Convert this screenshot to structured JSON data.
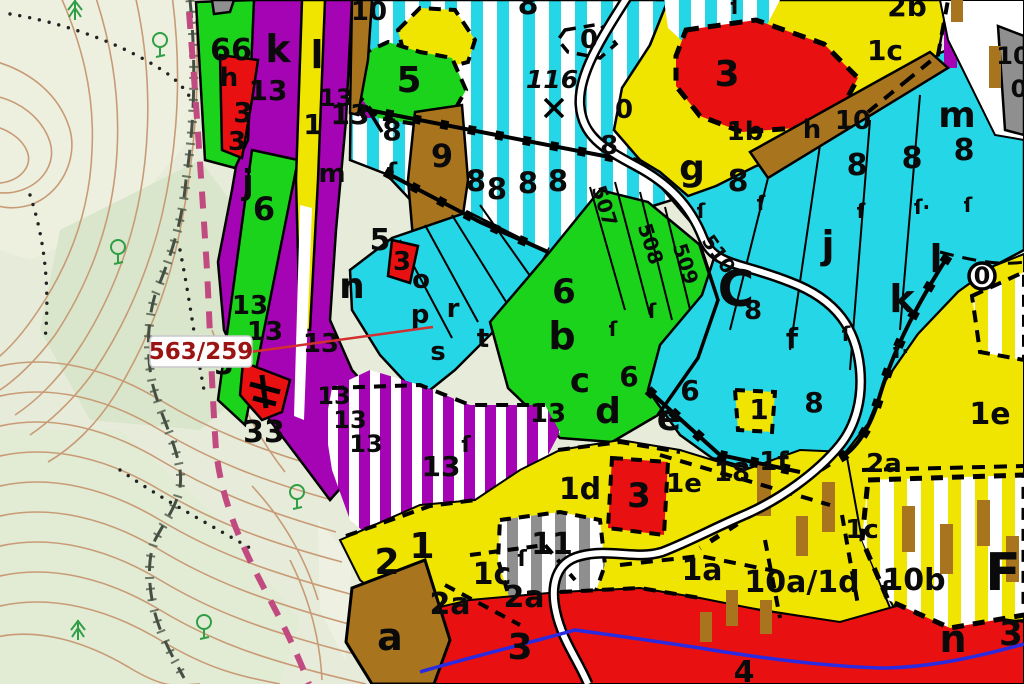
{
  "map": {
    "type": "forest-management-cadastral-map",
    "callout": {
      "parcel_number": "563/259",
      "text_color": "#9b1414"
    },
    "colors": {
      "topo_bg": "#e6ecd9",
      "contour": "#c89b76",
      "parcel_purple": "#a404b4",
      "parcel_green": "#1bd31b",
      "parcel_cyan": "#25d6e6",
      "parcel_yellow": "#f0e500",
      "parcel_red": "#e81010",
      "parcel_brown": "#a8751e",
      "parcel_gray": "#8f8f8f",
      "boundary_pink": "#c14b80",
      "river_blue": "#2a2ae0",
      "road_fill": "#ffffff",
      "road_casing": "#000000",
      "label": "#0a0a0a",
      "tree_green": "#2f9e44"
    },
    "trees": [
      {
        "k": "conifer",
        "x": 75,
        "y": 12
      },
      {
        "k": "deciduous",
        "x": 160,
        "y": 48
      },
      {
        "k": "deciduous",
        "x": 118,
        "y": 255
      },
      {
        "k": "deciduous",
        "x": 297,
        "y": 500
      },
      {
        "k": "conifer",
        "x": 78,
        "y": 632
      },
      {
        "k": "deciduous",
        "x": 204,
        "y": 630
      }
    ],
    "labels": [
      {
        "t": "66",
        "x": 231,
        "y": 60,
        "s": 30
      },
      {
        "t": "h",
        "x": 229,
        "y": 86,
        "s": 26
      },
      {
        "t": "13",
        "x": 268,
        "y": 100,
        "s": 28
      },
      {
        "t": "3",
        "x": 243,
        "y": 122,
        "s": 28
      },
      {
        "t": "3",
        "x": 237,
        "y": 150,
        "s": 26
      },
      {
        "t": "k",
        "x": 278,
        "y": 62,
        "s": 38
      },
      {
        "t": "l",
        "x": 317,
        "y": 68,
        "s": 38
      },
      {
        "t": "1",
        "x": 313,
        "y": 134,
        "s": 28
      },
      {
        "t": "13",
        "x": 336,
        "y": 106,
        "s": 24
      },
      {
        "t": "13",
        "x": 350,
        "y": 124,
        "s": 28
      },
      {
        "t": "8",
        "x": 392,
        "y": 140,
        "s": 28
      },
      {
        "t": "m",
        "x": 332,
        "y": 182,
        "s": 26
      },
      {
        "t": "j",
        "x": 248,
        "y": 194,
        "s": 34
      },
      {
        "t": "6",
        "x": 264,
        "y": 220,
        "s": 32
      },
      {
        "t": "5",
        "x": 409,
        "y": 92,
        "s": 36
      },
      {
        "t": "10",
        "x": 369,
        "y": 20,
        "s": 26
      },
      {
        "t": "9",
        "x": 442,
        "y": 167,
        "s": 32
      },
      {
        "t": "ſ",
        "x": 392,
        "y": 180,
        "s": 24
      },
      {
        "t": "n",
        "x": 352,
        "y": 298,
        "s": 36
      },
      {
        "t": "o",
        "x": 421,
        "y": 288,
        "s": 26
      },
      {
        "t": "p",
        "x": 420,
        "y": 323,
        "s": 26
      },
      {
        "t": "r",
        "x": 453,
        "y": 317,
        "s": 26
      },
      {
        "t": "s",
        "x": 438,
        "y": 360,
        "s": 26
      },
      {
        "t": "t",
        "x": 483,
        "y": 347,
        "s": 26
      },
      {
        "t": "3",
        "x": 402,
        "y": 270,
        "s": 26
      },
      {
        "t": "5",
        "x": 380,
        "y": 250,
        "s": 30
      },
      {
        "t": "13",
        "x": 250,
        "y": 314,
        "s": 26
      },
      {
        "t": "13",
        "x": 265,
        "y": 340,
        "s": 26
      },
      {
        "t": "13",
        "x": 321,
        "y": 352,
        "s": 26
      },
      {
        "t": "3",
        "x": 224,
        "y": 374,
        "s": 28
      },
      {
        "t": "33",
        "x": 264,
        "y": 442,
        "s": 30
      },
      {
        "t": "13",
        "x": 334,
        "y": 404,
        "s": 24
      },
      {
        "t": "13",
        "x": 350,
        "y": 428,
        "s": 24
      },
      {
        "t": "13",
        "x": 366,
        "y": 452,
        "s": 24
      },
      {
        "t": "13",
        "x": 441,
        "y": 476,
        "s": 28
      },
      {
        "t": "13",
        "x": 548,
        "y": 422,
        "s": 26
      },
      {
        "t": "ſ",
        "x": 466,
        "y": 452,
        "s": 22
      },
      {
        "t": "8",
        "x": 528,
        "y": 14,
        "s": 30
      },
      {
        "t": "ſ",
        "x": 735,
        "y": 14,
        "s": 22
      },
      {
        "t": "0",
        "x": 589,
        "y": 48,
        "s": 26
      },
      {
        "t": "116",
        "x": 552,
        "y": 88,
        "s": 25,
        "i": 1
      },
      {
        "t": "0",
        "x": 624,
        "y": 118,
        "s": 26
      },
      {
        "t": "8",
        "x": 609,
        "y": 154,
        "s": 26
      },
      {
        "t": "8",
        "x": 476,
        "y": 191,
        "s": 29
      },
      {
        "t": "8",
        "x": 497,
        "y": 199,
        "s": 29
      },
      {
        "t": "8",
        "x": 528,
        "y": 193,
        "s": 29
      },
      {
        "t": "8",
        "x": 558,
        "y": 191,
        "s": 29
      },
      {
        "t": "507",
        "x": 598,
        "y": 208,
        "s": 20,
        "r": 72
      },
      {
        "t": "508",
        "x": 644,
        "y": 246,
        "s": 20,
        "r": 72
      },
      {
        "t": "509",
        "x": 679,
        "y": 266,
        "s": 20,
        "r": 72
      },
      {
        "t": "510",
        "x": 713,
        "y": 258,
        "s": 20,
        "r": 55
      },
      {
        "t": "2b",
        "x": 907,
        "y": 16,
        "s": 28
      },
      {
        "t": "1c",
        "x": 885,
        "y": 60,
        "s": 28
      },
      {
        "t": "3",
        "x": 727,
        "y": 86,
        "s": 36
      },
      {
        "t": "1b",
        "x": 745,
        "y": 140,
        "s": 26
      },
      {
        "t": "h",
        "x": 812,
        "y": 138,
        "s": 26
      },
      {
        "t": "10",
        "x": 853,
        "y": 129,
        "s": 26
      },
      {
        "t": "g",
        "x": 692,
        "y": 180,
        "s": 36
      },
      {
        "t": "8",
        "x": 738,
        "y": 191,
        "s": 30
      },
      {
        "t": "8",
        "x": 857,
        "y": 175,
        "s": 30
      },
      {
        "t": "8",
        "x": 912,
        "y": 168,
        "s": 30
      },
      {
        "t": "8",
        "x": 964,
        "y": 160,
        "s": 30
      },
      {
        "t": "m",
        "x": 957,
        "y": 127,
        "s": 36
      },
      {
        "t": "10",
        "x": 1013,
        "y": 64,
        "s": 24
      },
      {
        "t": "0",
        "x": 1019,
        "y": 97,
        "s": 24
      },
      {
        "t": "ſ",
        "x": 701,
        "y": 218,
        "s": 20
      },
      {
        "t": "ſ",
        "x": 761,
        "y": 210,
        "s": 20
      },
      {
        "t": "ſ",
        "x": 861,
        "y": 218,
        "s": 20
      },
      {
        "t": "ſ·",
        "x": 922,
        "y": 214,
        "s": 20
      },
      {
        "t": "ſ",
        "x": 968,
        "y": 212,
        "s": 20
      },
      {
        "t": "C",
        "x": 736,
        "y": 306,
        "s": 50
      },
      {
        "t": "8",
        "x": 753,
        "y": 319,
        "s": 26
      },
      {
        "t": "f",
        "x": 792,
        "y": 348,
        "s": 28
      },
      {
        "t": "j",
        "x": 828,
        "y": 258,
        "s": 38
      },
      {
        "t": "k",
        "x": 902,
        "y": 312,
        "s": 38
      },
      {
        "t": "l",
        "x": 936,
        "y": 272,
        "s": 38
      },
      {
        "t": "0",
        "x": 982,
        "y": 284,
        "s": 24
      },
      {
        "t": "8",
        "x": 814,
        "y": 412,
        "s": 28
      },
      {
        "t": "1",
        "x": 759,
        "y": 419,
        "s": 28
      },
      {
        "t": "ſ",
        "x": 846,
        "y": 341,
        "s": 20
      },
      {
        "t": "ſ·",
        "x": 901,
        "y": 358,
        "s": 20
      },
      {
        "t": "6",
        "x": 564,
        "y": 303,
        "s": 34
      },
      {
        "t": "b",
        "x": 562,
        "y": 349,
        "s": 38
      },
      {
        "t": "c",
        "x": 580,
        "y": 392,
        "s": 34
      },
      {
        "t": "6",
        "x": 629,
        "y": 386,
        "s": 28
      },
      {
        "t": "d",
        "x": 608,
        "y": 423,
        "s": 36
      },
      {
        "t": "6",
        "x": 690,
        "y": 400,
        "s": 28
      },
      {
        "t": "e",
        "x": 669,
        "y": 430,
        "s": 36
      },
      {
        "t": "ſ",
        "x": 613,
        "y": 336,
        "s": 20
      },
      {
        "t": "ſ",
        "x": 652,
        "y": 318,
        "s": 20
      },
      {
        "t": "2",
        "x": 387,
        "y": 574,
        "s": 36
      },
      {
        "t": "1",
        "x": 422,
        "y": 558,
        "s": 36
      },
      {
        "t": "11",
        "x": 552,
        "y": 554,
        "s": 30
      },
      {
        "t": "ſ",
        "x": 522,
        "y": 566,
        "s": 22
      },
      {
        "t": "1c",
        "x": 492,
        "y": 584,
        "s": 30
      },
      {
        "t": "2a",
        "x": 450,
        "y": 614,
        "s": 30
      },
      {
        "t": "2a",
        "x": 524,
        "y": 607,
        "s": 30
      },
      {
        "t": "1d",
        "x": 580,
        "y": 499,
        "s": 30
      },
      {
        "t": "3",
        "x": 639,
        "y": 507,
        "s": 34
      },
      {
        "t": "1e",
        "x": 684,
        "y": 492,
        "s": 26
      },
      {
        "t": "18",
        "x": 732,
        "y": 481,
        "s": 26
      },
      {
        "t": "1f",
        "x": 774,
        "y": 470,
        "s": 26
      },
      {
        "t": "a",
        "x": 390,
        "y": 650,
        "s": 38
      },
      {
        "t": "3",
        "x": 520,
        "y": 659,
        "s": 36
      },
      {
        "t": "4",
        "x": 744,
        "y": 682,
        "s": 30
      },
      {
        "t": "1a",
        "x": 702,
        "y": 580,
        "s": 30
      },
      {
        "t": "10a/1d",
        "x": 802,
        "y": 592,
        "s": 30
      },
      {
        "t": "10b",
        "x": 914,
        "y": 590,
        "s": 30
      },
      {
        "t": "F",
        "x": 1003,
        "y": 590,
        "s": 52
      },
      {
        "t": "1c",
        "x": 862,
        "y": 538,
        "s": 26
      },
      {
        "t": "2a",
        "x": 884,
        "y": 472,
        "s": 26
      },
      {
        "t": "1e",
        "x": 990,
        "y": 424,
        "s": 30
      },
      {
        "t": "n",
        "x": 953,
        "y": 652,
        "s": 38
      },
      {
        "t": "3",
        "x": 1011,
        "y": 645,
        "s": 34
      },
      {
        "t": "ſ",
        "x": 886,
        "y": 597,
        "s": 22
      }
    ]
  }
}
